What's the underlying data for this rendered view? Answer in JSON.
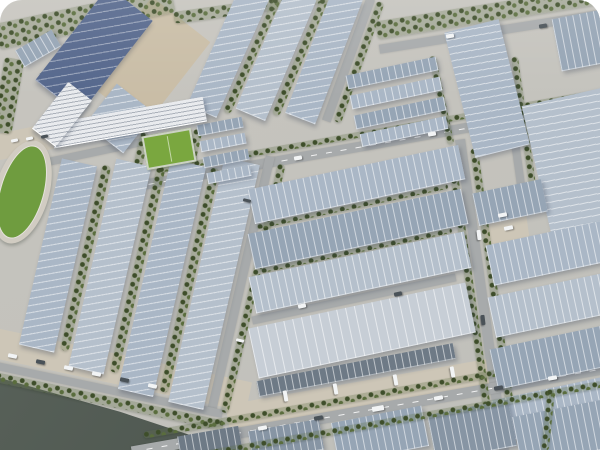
{
  "meta": {
    "description": "Aerial 3D rendering of a large industrial logistics park: rows of warehouse halls with striped blue-gray solar-panel roofs, tree-lined roads, a running-track stadium and mini soccer field at left, office building, canal with dark water at bottom-left, parked cars and trucks, white rounded top corners."
  },
  "palette": {
    "ground": "#c7c5bf",
    "apron": "#cdc6b7",
    "yard": "#c9bda6",
    "road": "#a7aaab",
    "water": "#59625a",
    "water-deep": "#4b544d",
    "tree-dark": "#3e4e2a",
    "tree-light": "#5a6d3d",
    "roof-light": "#aab7c6",
    "roof-light2": "#b5c0cc",
    "roof-mid": "#96a5b5",
    "roof-mid2": "#8795a4",
    "roof-dark": "#6e7a86",
    "roof-navy": "#55678c",
    "roof-bright": "#c7ced6",
    "office": "#e9ebee",
    "track": "#d1ccc2",
    "field-green": "#6f9c3f",
    "mini-green": "#7aa73f",
    "car-white": "#f2f4f5",
    "car-dark": "#4a5258"
  },
  "elements": [
    {
      "n": "yard-north",
      "t": "flat",
      "c": "fill-yard",
      "cx": 148,
      "cy": 62,
      "w": 74,
      "h": 108,
      "r": 38
    },
    {
      "n": "apron-waterfront",
      "t": "flat",
      "c": "fill-apron",
      "cx": 112,
      "cy": 368,
      "w": 280,
      "h": 30,
      "r": 12
    },
    {
      "n": "apron-bottom",
      "t": "flat",
      "c": "fill-apron",
      "cx": 420,
      "cy": 386,
      "w": 390,
      "h": 30,
      "r": -10
    },
    {
      "n": "apron-stadium",
      "t": "flat",
      "c": "fill-apron",
      "cx": 32,
      "cy": 140,
      "w": 72,
      "h": 26,
      "r": -12
    },
    {
      "n": "apron-intersection",
      "t": "flat",
      "c": "fill-apron",
      "cx": 505,
      "cy": 222,
      "w": 44,
      "h": 54,
      "r": -8
    },
    {
      "n": "road-top-right",
      "t": "road",
      "cx": 498,
      "cy": 30,
      "w": 240,
      "h": 9,
      "r": -9
    },
    {
      "n": "road-east-west",
      "t": "road",
      "dash": 1,
      "cx": 375,
      "cy": 144,
      "w": 490,
      "h": 10,
      "r": -10
    },
    {
      "n": "road-left-vertical",
      "t": "road",
      "cx": 240,
      "cy": 285,
      "w": 9,
      "h": 265,
      "r": 13
    },
    {
      "n": "road-mid-vertical",
      "t": "road",
      "cx": 348,
      "cy": 60,
      "w": 9,
      "h": 130,
      "r": 20
    },
    {
      "n": "road-right-vertical",
      "t": "road",
      "cx": 482,
      "cy": 295,
      "w": 10,
      "h": 315,
      "r": -8
    },
    {
      "n": "road-topright-vertical",
      "t": "road",
      "cx": 513,
      "cy": 128,
      "w": 8,
      "h": 150,
      "r": -8
    },
    {
      "n": "road-center-mid",
      "t": "road",
      "cx": 354,
      "cy": 299,
      "w": 208,
      "h": 8,
      "r": -12
    },
    {
      "n": "road-stadium-link",
      "t": "road",
      "cx": 95,
      "cy": 152,
      "w": 130,
      "h": 8,
      "r": -12
    },
    {
      "n": "water-canal",
      "t": "water",
      "pts": "0% 84%, 20% 91.5%, 34% 97.7%, 39.5% 100%, 0% 100%"
    },
    {
      "n": "road-main-bottom",
      "t": "road",
      "dash": 1,
      "cx": 378,
      "cy": 408,
      "w": 500,
      "h": 11,
      "r": -10
    },
    {
      "n": "trees-bank",
      "t": "trees",
      "cx": 103,
      "cy": 400,
      "w": 245,
      "h": 10,
      "r": 12
    },
    {
      "n": "road-bank",
      "t": "road",
      "cx": 105,
      "cy": 389,
      "w": 240,
      "h": 8,
      "r": 12
    },
    {
      "n": "trees-top-left",
      "t": "trees",
      "cx": 85,
      "cy": 18,
      "w": 180,
      "h": 26,
      "r": -12
    },
    {
      "n": "trees-top-mid",
      "t": "trees",
      "cx": 258,
      "cy": 6,
      "w": 170,
      "h": 12,
      "r": -8
    },
    {
      "n": "trees-top-right",
      "t": "trees",
      "cx": 492,
      "cy": 12,
      "w": 235,
      "h": 18,
      "r": -9
    },
    {
      "n": "trees-left-edge",
      "t": "trees",
      "cx": 8,
      "cy": 95,
      "w": 20,
      "h": 75,
      "r": 10
    },
    {
      "n": "trees-left-lane-1",
      "t": "trees",
      "cx": 85,
      "cy": 258,
      "w": 9,
      "h": 190,
      "r": 13
    },
    {
      "n": "trees-left-lane-2",
      "t": "trees",
      "cx": 137,
      "cy": 270,
      "w": 9,
      "h": 210,
      "r": 13
    },
    {
      "n": "trees-left-lane-3",
      "t": "trees",
      "cx": 189,
      "cy": 280,
      "w": 9,
      "h": 230,
      "r": 13
    },
    {
      "n": "trees-left-road",
      "t": "trees",
      "cx": 253,
      "cy": 288,
      "w": 8,
      "h": 255,
      "r": 13
    },
    {
      "n": "trees-topcenter-1",
      "t": "trees",
      "cx": 252,
      "cy": 55,
      "w": 8,
      "h": 125,
      "r": 24
    },
    {
      "n": "trees-topcenter-2",
      "t": "trees",
      "cx": 300,
      "cy": 57,
      "w": 8,
      "h": 126,
      "r": 23
    },
    {
      "n": "trees-midroad",
      "t": "trees",
      "cx": 359,
      "cy": 62,
      "w": 8,
      "h": 128,
      "r": 20
    },
    {
      "n": "trees-ctop-side",
      "t": "trees",
      "cx": 441,
      "cy": 100,
      "w": 7,
      "h": 90,
      "r": -12
    },
    {
      "n": "trees-rightroad-west",
      "t": "trees",
      "cx": 471,
      "cy": 295,
      "w": 8,
      "h": 290,
      "r": -8
    },
    {
      "n": "trees-rightroad-east",
      "t": "trees",
      "cx": 494,
      "cy": 292,
      "w": 8,
      "h": 290,
      "r": -8
    },
    {
      "n": "trees-topright-road",
      "t": "trees",
      "cx": 524,
      "cy": 128,
      "w": 7,
      "h": 145,
      "r": -8
    },
    {
      "n": "trees-eastwest-north",
      "t": "trees",
      "cx": 380,
      "cy": 131,
      "w": 450,
      "h": 6,
      "r": -10
    },
    {
      "n": "trees-bottom-north",
      "t": "trees",
      "cx": 375,
      "cy": 394,
      "w": 470,
      "h": 7,
      "r": -10
    },
    {
      "n": "trees-minifield-left",
      "t": "trees",
      "cx": 141,
      "cy": 149,
      "w": 9,
      "h": 34,
      "r": 13
    },
    {
      "n": "trees-minifield-right",
      "t": "trees",
      "cx": 194,
      "cy": 146,
      "w": 9,
      "h": 34,
      "r": 13
    },
    {
      "n": "trees-center-gap-1",
      "t": "trees",
      "cx": 352,
      "cy": 206,
      "w": 195,
      "h": 5,
      "r": -12
    },
    {
      "n": "trees-center-gap-2",
      "t": "trees",
      "cx": 356,
      "cy": 250,
      "w": 195,
      "h": 5,
      "r": -12
    },
    {
      "n": "warehouse-topleft-a",
      "t": "bldg",
      "c": "roof-mid",
      "s": "v",
      "cx": 38,
      "cy": 48,
      "w": 42,
      "h": 18,
      "r": -30
    },
    {
      "n": "warehouse-topleft-b",
      "t": "bldg",
      "c": "roof-dark",
      "s": "v",
      "cx": 62,
      "cy": 70,
      "w": 44,
      "h": 16,
      "r": -30
    },
    {
      "n": "hall-navy-solar",
      "t": "bldg",
      "c": "roof-navy",
      "s": "h",
      "cx": 94,
      "cy": 50,
      "w": 56,
      "h": 118,
      "r": 38,
      "pitch": 8
    },
    {
      "n": "hall-navy-annex",
      "t": "bldg",
      "c": "roof-light",
      "s": "h",
      "cx": 120,
      "cy": 118,
      "w": 48,
      "h": 50,
      "r": 38
    },
    {
      "n": "hall-left-1",
      "t": "bldg",
      "c": "roof-light",
      "s": "h",
      "cx": 58,
      "cy": 255,
      "w": 36,
      "h": 190,
      "r": 13
    },
    {
      "n": "hall-left-2",
      "t": "bldg",
      "c": "roof-light2",
      "s": "h",
      "cx": 110,
      "cy": 266,
      "w": 36,
      "h": 212,
      "r": 13
    },
    {
      "n": "hall-left-3",
      "t": "bldg",
      "c": "roof-light",
      "s": "h",
      "cx": 162,
      "cy": 277,
      "w": 36,
      "h": 235,
      "r": 13
    },
    {
      "n": "hall-left-4",
      "t": "bldg",
      "c": "roof-light2",
      "s": "h",
      "cx": 214,
      "cy": 283,
      "w": 36,
      "h": 250,
      "r": 13
    },
    {
      "n": "hall-topcenter-1",
      "t": "bldg",
      "c": "roof-light",
      "s": "h",
      "cx": 228,
      "cy": 52,
      "w": 32,
      "h": 128,
      "r": 24
    },
    {
      "n": "hall-topcenter-2",
      "t": "bldg",
      "c": "roof-light2",
      "s": "h",
      "cx": 276,
      "cy": 54,
      "w": 32,
      "h": 130,
      "r": 23
    },
    {
      "n": "hall-topcenter-3",
      "t": "bldg",
      "c": "roof-light",
      "s": "h",
      "cx": 324,
      "cy": 56,
      "w": 32,
      "h": 132,
      "r": 21
    },
    {
      "n": "units-row-1",
      "t": "bldg",
      "c": "roof-mid",
      "s": "v",
      "cx": 220,
      "cy": 126,
      "w": 46,
      "h": 10,
      "r": -11
    },
    {
      "n": "units-row-2",
      "t": "bldg",
      "c": "roof-light",
      "s": "v",
      "cx": 223,
      "cy": 142,
      "w": 46,
      "h": 10,
      "r": -11
    },
    {
      "n": "units-row-3",
      "t": "bldg",
      "c": "roof-mid",
      "s": "v",
      "cx": 226,
      "cy": 158,
      "w": 46,
      "h": 10,
      "r": -11
    },
    {
      "n": "units-row-4",
      "t": "bldg",
      "c": "roof-light",
      "s": "v",
      "cx": 229,
      "cy": 174,
      "w": 44,
      "h": 10,
      "r": -11
    },
    {
      "n": "workshop-row-1",
      "t": "bldg",
      "c": "roof-mid",
      "s": "v",
      "cx": 392,
      "cy": 72,
      "w": 92,
      "h": 13,
      "r": -12
    },
    {
      "n": "workshop-row-2",
      "t": "bldg",
      "c": "roof-light",
      "s": "v",
      "cx": 396,
      "cy": 92,
      "w": 92,
      "h": 13,
      "r": -12
    },
    {
      "n": "workshop-row-3",
      "t": "bldg",
      "c": "roof-mid",
      "s": "v",
      "cx": 400,
      "cy": 112,
      "w": 92,
      "h": 13,
      "r": -12
    },
    {
      "n": "workshop-row-4",
      "t": "bldg",
      "c": "roof-light",
      "s": "v",
      "cx": 404,
      "cy": 131,
      "w": 88,
      "h": 12,
      "r": -12
    },
    {
      "n": "hall-topright-slab",
      "t": "bldg",
      "c": "roof-light",
      "s": "h",
      "cx": 487,
      "cy": 88,
      "w": 56,
      "h": 128,
      "r": -14
    },
    {
      "n": "hall-topright-big",
      "t": "bldg",
      "c": "roof-light2",
      "s": "h",
      "cx": 578,
      "cy": 162,
      "w": 85,
      "h": 135,
      "r": -13
    },
    {
      "n": "hall-topright-corner",
      "t": "bldg",
      "c": "roof-mid",
      "s": "v",
      "cx": 592,
      "cy": 38,
      "w": 72,
      "h": 52,
      "r": -11
    },
    {
      "n": "hall-center-a",
      "t": "bldg",
      "c": "roof-light",
      "s": "v",
      "cx": 356,
      "cy": 184,
      "w": 215,
      "h": 34,
      "r": -12
    },
    {
      "n": "hall-center-b",
      "t": "bldg",
      "c": "roof-mid",
      "s": "v",
      "cx": 358,
      "cy": 228,
      "w": 218,
      "h": 35,
      "r": -12
    },
    {
      "n": "hall-center-c",
      "t": "bldg",
      "c": "roof-light2",
      "s": "v",
      "cx": 360,
      "cy": 272,
      "w": 220,
      "h": 36,
      "r": -12
    },
    {
      "n": "hall-center-bright",
      "t": "bldg",
      "c": "roof-bright",
      "s": "v",
      "cx": 362,
      "cy": 330,
      "w": 222,
      "h": 50,
      "r": -12,
      "pitch": 9
    },
    {
      "n": "hall-center-darkstrip",
      "t": "bldg",
      "c": "roof-dark",
      "s": "v",
      "cx": 356,
      "cy": 369,
      "w": 200,
      "h": 15,
      "r": -11
    },
    {
      "n": "hall-right-0",
      "t": "bldg",
      "c": "roof-mid",
      "s": "v",
      "cx": 510,
      "cy": 202,
      "w": 70,
      "h": 32,
      "r": -12
    },
    {
      "n": "hall-right-1",
      "t": "bldg",
      "c": "roof-light",
      "s": "v",
      "cx": 570,
      "cy": 248,
      "w": 165,
      "h": 40,
      "r": -12
    },
    {
      "n": "hall-right-2",
      "t": "bldg",
      "c": "roof-light2",
      "s": "v",
      "cx": 572,
      "cy": 300,
      "w": 165,
      "h": 40,
      "r": -12
    },
    {
      "n": "hall-right-3",
      "t": "bldg",
      "c": "roof-mid",
      "s": "v",
      "cx": 574,
      "cy": 352,
      "w": 165,
      "h": 40,
      "r": -12
    },
    {
      "n": "hall-right-4",
      "t": "bldg",
      "c": "roof-light",
      "s": "v",
      "cx": 576,
      "cy": 404,
      "w": 165,
      "h": 42,
      "r": -12
    },
    {
      "n": "office-main",
      "t": "office",
      "cx": 128,
      "cy": 122,
      "w": 155,
      "h": 24,
      "r": -10
    },
    {
      "n": "office-wing",
      "t": "office",
      "cx": 62,
      "cy": 114,
      "w": 30,
      "h": 58,
      "r": 38
    },
    {
      "n": "mini-soccer-field",
      "t": "field",
      "cx": 167,
      "cy": 147,
      "w": 46,
      "h": 30,
      "r": -10
    },
    {
      "n": "stadium-track",
      "t": "stadium",
      "cx": 22,
      "cy": 192,
      "w": 54,
      "h": 106,
      "r": 16
    },
    {
      "n": "hall-south-1",
      "t": "bldg",
      "c": "roof-dark",
      "s": "v",
      "cx": 210,
      "cy": 444,
      "w": 62,
      "h": 26,
      "r": -10
    },
    {
      "n": "hall-south-2",
      "t": "bldg",
      "c": "roof-mid2",
      "s": "v",
      "cx": 286,
      "cy": 440,
      "w": 72,
      "h": 30,
      "r": -10
    },
    {
      "n": "hall-south-3",
      "t": "bldg",
      "c": "roof-mid",
      "s": "v",
      "cx": 380,
      "cy": 434,
      "w": 92,
      "h": 40,
      "r": -11
    },
    {
      "n": "hall-south-4",
      "t": "bldg",
      "c": "roof-mid2",
      "s": "v",
      "cx": 472,
      "cy": 430,
      "w": 82,
      "h": 46,
      "r": -11
    },
    {
      "n": "hall-south-5",
      "t": "bldg",
      "c": "roof-mid",
      "s": "v",
      "cx": 562,
      "cy": 432,
      "w": 92,
      "h": 48,
      "r": -11
    },
    {
      "n": "trees-bottom-south",
      "t": "trees",
      "cx": 390,
      "cy": 421,
      "w": 430,
      "h": 7,
      "r": -10
    },
    {
      "n": "trees-corner-southeast",
      "t": "trees",
      "cx": 548,
      "cy": 420,
      "w": 8,
      "h": 62,
      "r": 6
    },
    {
      "n": "car",
      "t": "car",
      "c": "car-white",
      "cx": 450,
      "cy": 36,
      "w": 8,
      "h": 4,
      "r": -9
    },
    {
      "n": "car",
      "t": "car",
      "c": "car-dark",
      "cx": 543,
      "cy": 26,
      "w": 8,
      "h": 4,
      "r": -9
    },
    {
      "n": "car",
      "t": "car",
      "c": "car-white",
      "cx": 298,
      "cy": 158,
      "w": 8,
      "h": 4,
      "r": -10
    },
    {
      "n": "car",
      "t": "car",
      "c": "car-white",
      "cx": 432,
      "cy": 134,
      "w": 8,
      "h": 4,
      "r": -10
    },
    {
      "n": "car",
      "t": "car",
      "c": "car-white",
      "cx": 12,
      "cy": 356,
      "w": 9,
      "h": 4,
      "r": 12
    },
    {
      "n": "car",
      "t": "car",
      "c": "car-dark",
      "cx": 40,
      "cy": 362,
      "w": 9,
      "h": 4,
      "r": 12
    },
    {
      "n": "car",
      "t": "car",
      "c": "car-white",
      "cx": 68,
      "cy": 368,
      "w": 9,
      "h": 4,
      "r": 12
    },
    {
      "n": "car",
      "t": "car",
      "c": "car-white",
      "cx": 96,
      "cy": 374,
      "w": 9,
      "h": 4,
      "r": 12
    },
    {
      "n": "car",
      "t": "car",
      "c": "car-dark",
      "cx": 124,
      "cy": 380,
      "w": 9,
      "h": 4,
      "r": 12
    },
    {
      "n": "car",
      "t": "car",
      "c": "car-white",
      "cx": 152,
      "cy": 386,
      "w": 9,
      "h": 4,
      "r": 12
    },
    {
      "n": "car",
      "t": "car",
      "c": "car-white",
      "cx": 262,
      "cy": 428,
      "w": 9,
      "h": 4,
      "r": -10
    },
    {
      "n": "car",
      "t": "car",
      "c": "car-dark",
      "cx": 318,
      "cy": 418,
      "w": 9,
      "h": 4,
      "r": -10
    },
    {
      "n": "car",
      "t": "car",
      "c": "car-white",
      "cx": 378,
      "cy": 408,
      "w": 12,
      "h": 5,
      "r": -10
    },
    {
      "n": "car",
      "t": "car",
      "c": "car-white",
      "cx": 438,
      "cy": 398,
      "w": 9,
      "h": 4,
      "r": -10
    },
    {
      "n": "car",
      "t": "car",
      "c": "car-dark",
      "cx": 498,
      "cy": 388,
      "w": 9,
      "h": 4,
      "r": -10
    },
    {
      "n": "car",
      "t": "car",
      "c": "car-white",
      "cx": 552,
      "cy": 378,
      "w": 9,
      "h": 4,
      "r": -10
    },
    {
      "n": "truck",
      "t": "car",
      "c": "car-white",
      "cx": 285,
      "cy": 396,
      "w": 11,
      "h": 4,
      "r": 80
    },
    {
      "n": "truck",
      "t": "car",
      "c": "car-white",
      "cx": 335,
      "cy": 389,
      "w": 11,
      "h": 4,
      "r": 80
    },
    {
      "n": "truck",
      "t": "car",
      "c": "car-white",
      "cx": 395,
      "cy": 380,
      "w": 11,
      "h": 4,
      "r": 80
    },
    {
      "n": "truck",
      "t": "car",
      "c": "car-white",
      "cx": 452,
      "cy": 372,
      "w": 11,
      "h": 4,
      "r": 80
    },
    {
      "n": "car",
      "t": "car",
      "c": "car-white",
      "cx": 302,
      "cy": 306,
      "w": 8,
      "h": 4,
      "r": -12
    },
    {
      "n": "car",
      "t": "car",
      "c": "car-dark",
      "cx": 398,
      "cy": 294,
      "w": 8,
      "h": 4,
      "r": -12
    },
    {
      "n": "car",
      "t": "car",
      "c": "car-white",
      "cx": 14,
      "cy": 140,
      "w": 7,
      "h": 3,
      "r": -12
    },
    {
      "n": "car",
      "t": "car",
      "c": "car-white",
      "cx": 29,
      "cy": 138,
      "w": 7,
      "h": 3,
      "r": -12
    },
    {
      "n": "car",
      "t": "car",
      "c": "car-dark",
      "cx": 44,
      "cy": 136,
      "w": 7,
      "h": 3,
      "r": -12
    },
    {
      "n": "truck",
      "t": "car",
      "c": "car-white",
      "cx": 479,
      "cy": 235,
      "w": 10,
      "h": 4,
      "r": 83
    },
    {
      "n": "truck",
      "t": "car",
      "c": "car-dark",
      "cx": 483,
      "cy": 320,
      "w": 10,
      "h": 4,
      "r": 83
    },
    {
      "n": "truck",
      "t": "car",
      "c": "car-white",
      "cx": 502,
      "cy": 215,
      "w": 9,
      "h": 4,
      "r": -12
    },
    {
      "n": "truck",
      "t": "car",
      "c": "car-white",
      "cx": 508,
      "cy": 228,
      "w": 9,
      "h": 4,
      "r": -12
    },
    {
      "n": "car",
      "t": "car",
      "c": "car-dark",
      "cx": 247,
      "cy": 200,
      "w": 8,
      "h": 3,
      "r": 13
    },
    {
      "n": "car",
      "t": "car",
      "c": "car-white",
      "cx": 240,
      "cy": 340,
      "w": 8,
      "h": 3,
      "r": 13
    }
  ]
}
